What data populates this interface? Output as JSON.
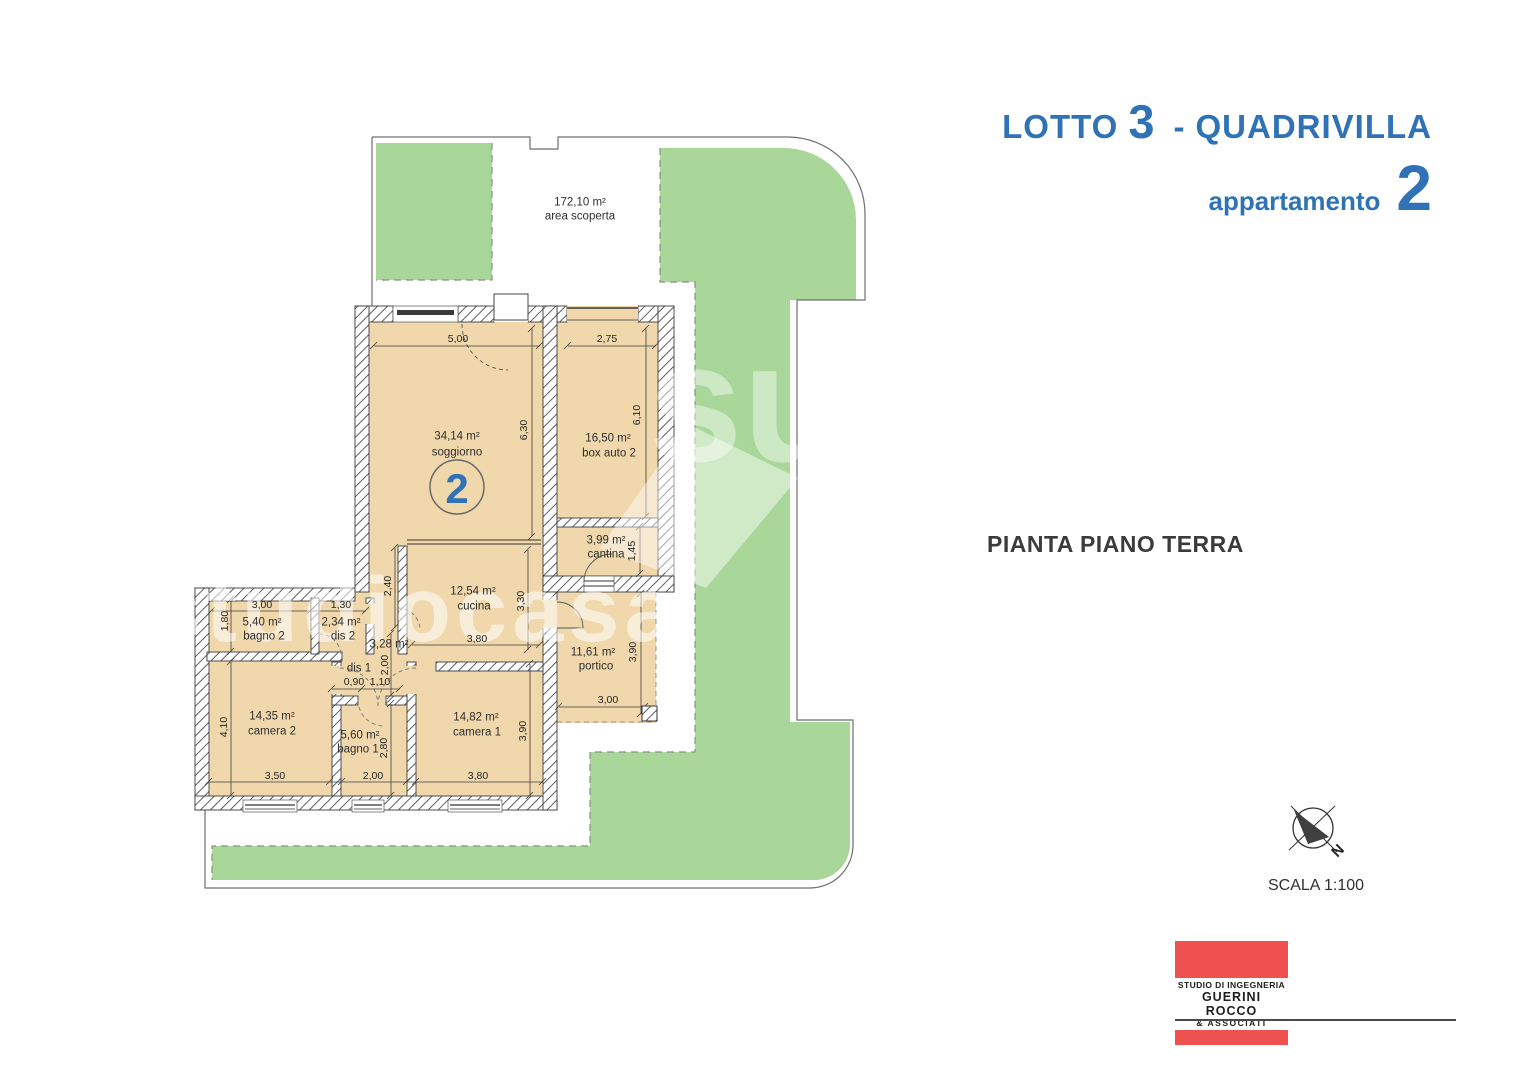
{
  "header": {
    "lotto_label": "LOTTO",
    "lotto_number": "3",
    "separator": "-",
    "project_name": "QUADRIVILLA",
    "apartment_label": "appartamento",
    "apartment_number": "2"
  },
  "plan": {
    "title": "PIANTA PIANO TERRA",
    "scale": "SCALA 1:100",
    "north": "N",
    "unit_badge": "2",
    "outdoor": {
      "area": "172,10 m²",
      "label": "area scoperta"
    },
    "rooms": {
      "soggiorno": {
        "area": "34,14 m²",
        "label": "soggiorno"
      },
      "box_auto": {
        "area": "16,50 m²",
        "label": "box auto 2"
      },
      "cantina": {
        "area": "3,99 m²",
        "label": "cantina"
      },
      "cucina": {
        "area": "12,54 m²",
        "label": "cucina"
      },
      "bagno2": {
        "area": "5,40 m²",
        "label": "bagno 2"
      },
      "dis2": {
        "area": "2,34 m²",
        "label": "dis 2"
      },
      "dis1": {
        "area": "3,28 m²",
        "label": "dis 1"
      },
      "camera2": {
        "area": "14,35 m²",
        "label": "camera 2"
      },
      "bagno1": {
        "area": "5,60 m²",
        "label": "bagno 1"
      },
      "camera1": {
        "area": "14,82 m²",
        "label": "camera 1"
      },
      "portico": {
        "area": "11,61 m²",
        "label": "portico"
      }
    },
    "dims": {
      "soggiorno_w": "5,00",
      "soggiorno_h": "6,30",
      "box_w": "2,75",
      "box_h": "6,10",
      "corridor_h": "2,40",
      "cantina_h": "1,45",
      "cucina_w": "3,80",
      "cucina_h": "3,30",
      "bagno2_w": "3,00",
      "bagno2_h": "1,80",
      "dis2_w": "1,30",
      "dis1_w1": "0,90",
      "dis1_w2": "1,10",
      "dis1_h": "2,00",
      "camera2_w": "3,50",
      "camera2_h": "4,10",
      "bagno1_w": "2,00",
      "bagno1_h": "2,80",
      "camera1_w": "3,80",
      "camera1_h": "3,90",
      "portico_w": "3,00",
      "portico_h": "3,90"
    }
  },
  "watermark": {
    "text": "studiocasa",
    "mark_text": "su"
  },
  "footer": {
    "studio_line1": "STUDIO DI INGEGNERIA",
    "studio_line2": "GUERINI ROCCO",
    "studio_line3": "& ASSOCIATI"
  },
  "colors": {
    "accent_blue": "#2f73b6",
    "site_green": "#a9d79a",
    "room_tan": "#f0d8ac",
    "logo_red": "#ee514f"
  }
}
